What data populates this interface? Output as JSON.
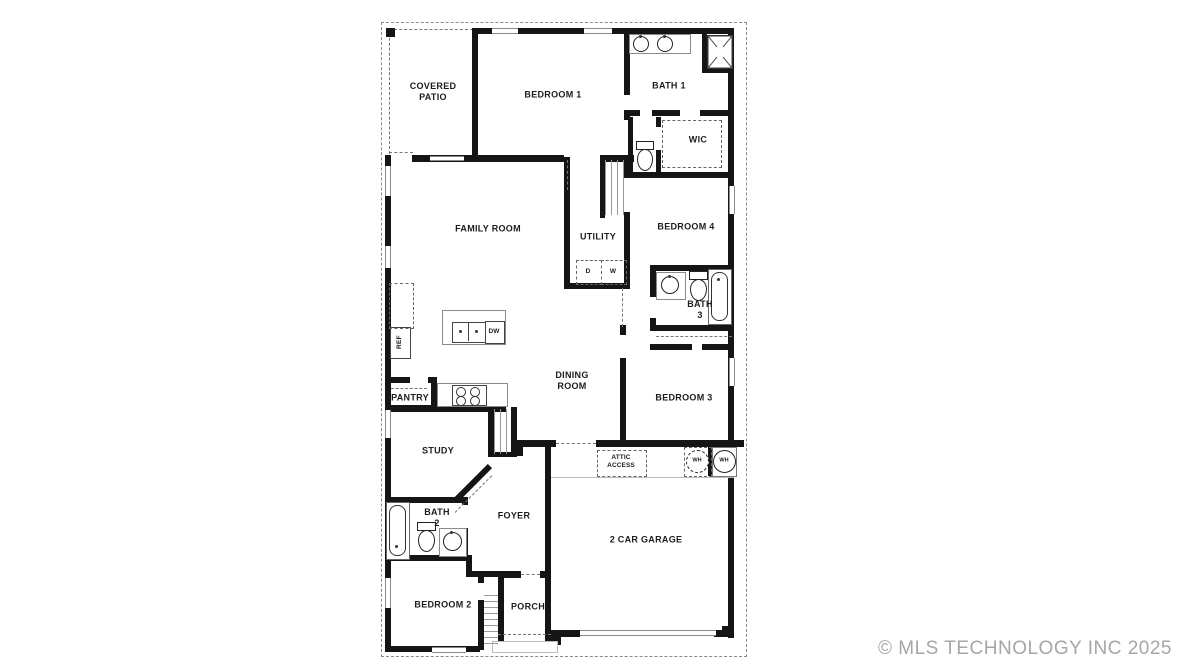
{
  "plan": {
    "title_hint": "single-story residential floor plan",
    "labels": {
      "covered_patio": "COVERED\nPATIO",
      "bedroom_1": "BEDROOM 1",
      "bath_1": "BATH 1",
      "wic": "WIC",
      "family_room": "FAMILY ROOM",
      "utility": "UTILITY",
      "bedroom_4": "BEDROOM 4",
      "bath_3": "BATH\n3",
      "dining_room": "DINING\nROOM",
      "bedroom_3": "BEDROOM 3",
      "pantry": "PANTRY",
      "ref": "REF",
      "dw": "DW",
      "dryer": "D",
      "washer": "W",
      "study": "STUDY",
      "bath_2": "BATH\n2",
      "foyer": "FOYER",
      "bedroom_2": "BEDROOM 2",
      "porch": "PORCH",
      "garage": "2 CAR GARAGE",
      "attic_access": "ATTIC\nACCESS",
      "wh_1": "WH",
      "wh_2": "WH"
    },
    "watermark": "© MLS TECHNOLOGY INC 2025"
  },
  "colors": {
    "wall": "#151515",
    "watermark": "#a6a6a6",
    "background": "#ffffff"
  }
}
